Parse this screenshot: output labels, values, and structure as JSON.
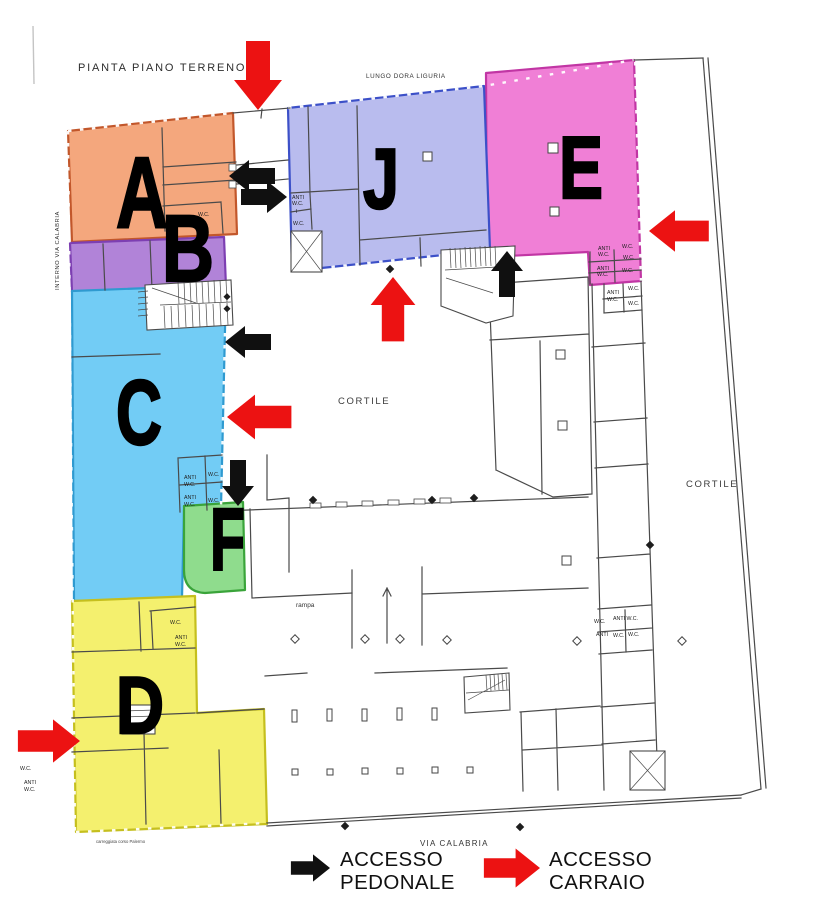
{
  "title": "PIANTA PIANO TERRENO",
  "streets": {
    "top": "LUNGO DORA LIGURIA",
    "left": "INTERNO VIA CALABRIA",
    "bottom": "VIA CALABRIA",
    "bottom_note": "carreggiata corso Palermo"
  },
  "areas": {
    "courtyard_center": "CORTILE",
    "courtyard_right": "CORTILE",
    "ramp": "rampa"
  },
  "rooms": {
    "wc": "W.C.",
    "anti": "ANTI",
    "anti_wc": "ANTI W.C.",
    "i": "I"
  },
  "zones": [
    {
      "id": "A",
      "label": "A",
      "fill": "#f4a77d",
      "stroke": "#c2572b"
    },
    {
      "id": "B",
      "label": "B",
      "fill": "#b183d8",
      "stroke": "#7d3fb2"
    },
    {
      "id": "C",
      "label": "C",
      "fill": "#72ccf5",
      "stroke": "#2f9ad0"
    },
    {
      "id": "D",
      "label": "D",
      "fill": "#f4f06e",
      "stroke": "#c5bf1e"
    },
    {
      "id": "E",
      "label": "E",
      "fill": "#f07fd6",
      "stroke": "#c136a4"
    },
    {
      "id": "F",
      "label": "F",
      "fill": "#8fdc8d",
      "stroke": "#3aa43a"
    },
    {
      "id": "J",
      "label": "J",
      "fill": "#b9bcee",
      "stroke": "#3c50c8"
    }
  ],
  "legend": {
    "pedestrian": {
      "line1": "ACCESSO",
      "line2": "PEDONALE",
      "color": "#101010"
    },
    "vehicle": {
      "line1": "ACCESSO",
      "line2": "CARRAIO",
      "color": "#ec1212"
    }
  },
  "access_points": [
    {
      "type": "carraio",
      "at": "top-lungo-dora"
    },
    {
      "type": "pedonale",
      "at": "zone-a-east"
    },
    {
      "type": "pedonale",
      "at": "zone-j-west"
    },
    {
      "type": "carraio",
      "at": "zone-j-south"
    },
    {
      "type": "pedonale",
      "at": "zone-e-stairs"
    },
    {
      "type": "carraio",
      "at": "zone-e-east"
    },
    {
      "type": "pedonale",
      "at": "zone-c-east"
    },
    {
      "type": "carraio",
      "at": "zone-c-east-lower"
    },
    {
      "type": "pedonale",
      "at": "zone-f-north"
    },
    {
      "type": "carraio",
      "at": "zone-d-west"
    }
  ]
}
